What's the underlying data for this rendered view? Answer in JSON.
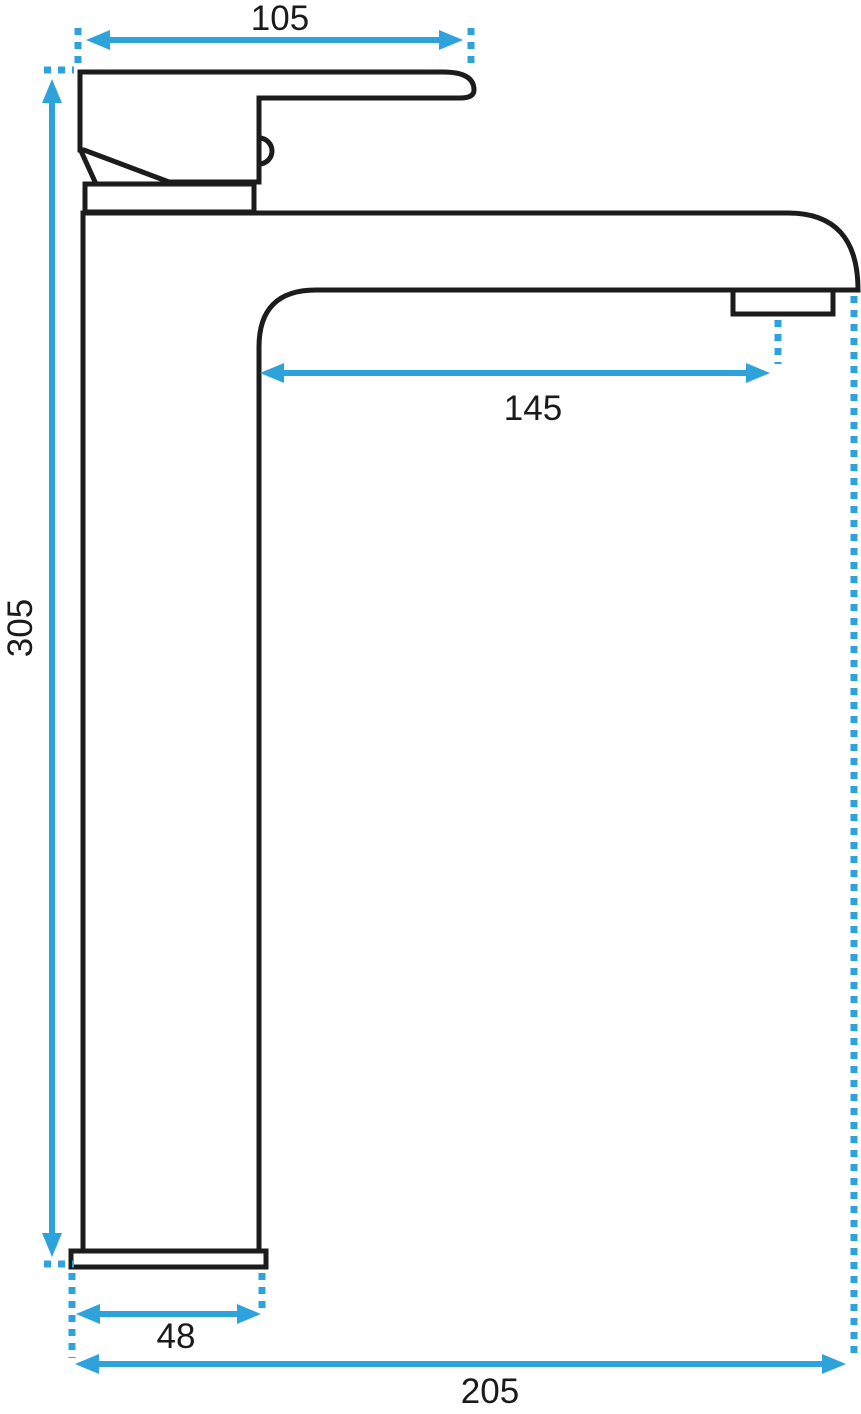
{
  "drawing": {
    "object": "single-lever-tall-basin-faucet-side-view",
    "outline_color": "#1c1c1c",
    "accent_color": "#2ea3db",
    "label_color": "#1a1a1a",
    "background_color": "#ffffff",
    "dimensions": {
      "handle_width": {
        "label": "105"
      },
      "spout_reach": {
        "label": "145"
      },
      "total_height": {
        "label": "305"
      },
      "base_width": {
        "label": "48"
      },
      "overall_depth": {
        "label": "205"
      }
    }
  }
}
